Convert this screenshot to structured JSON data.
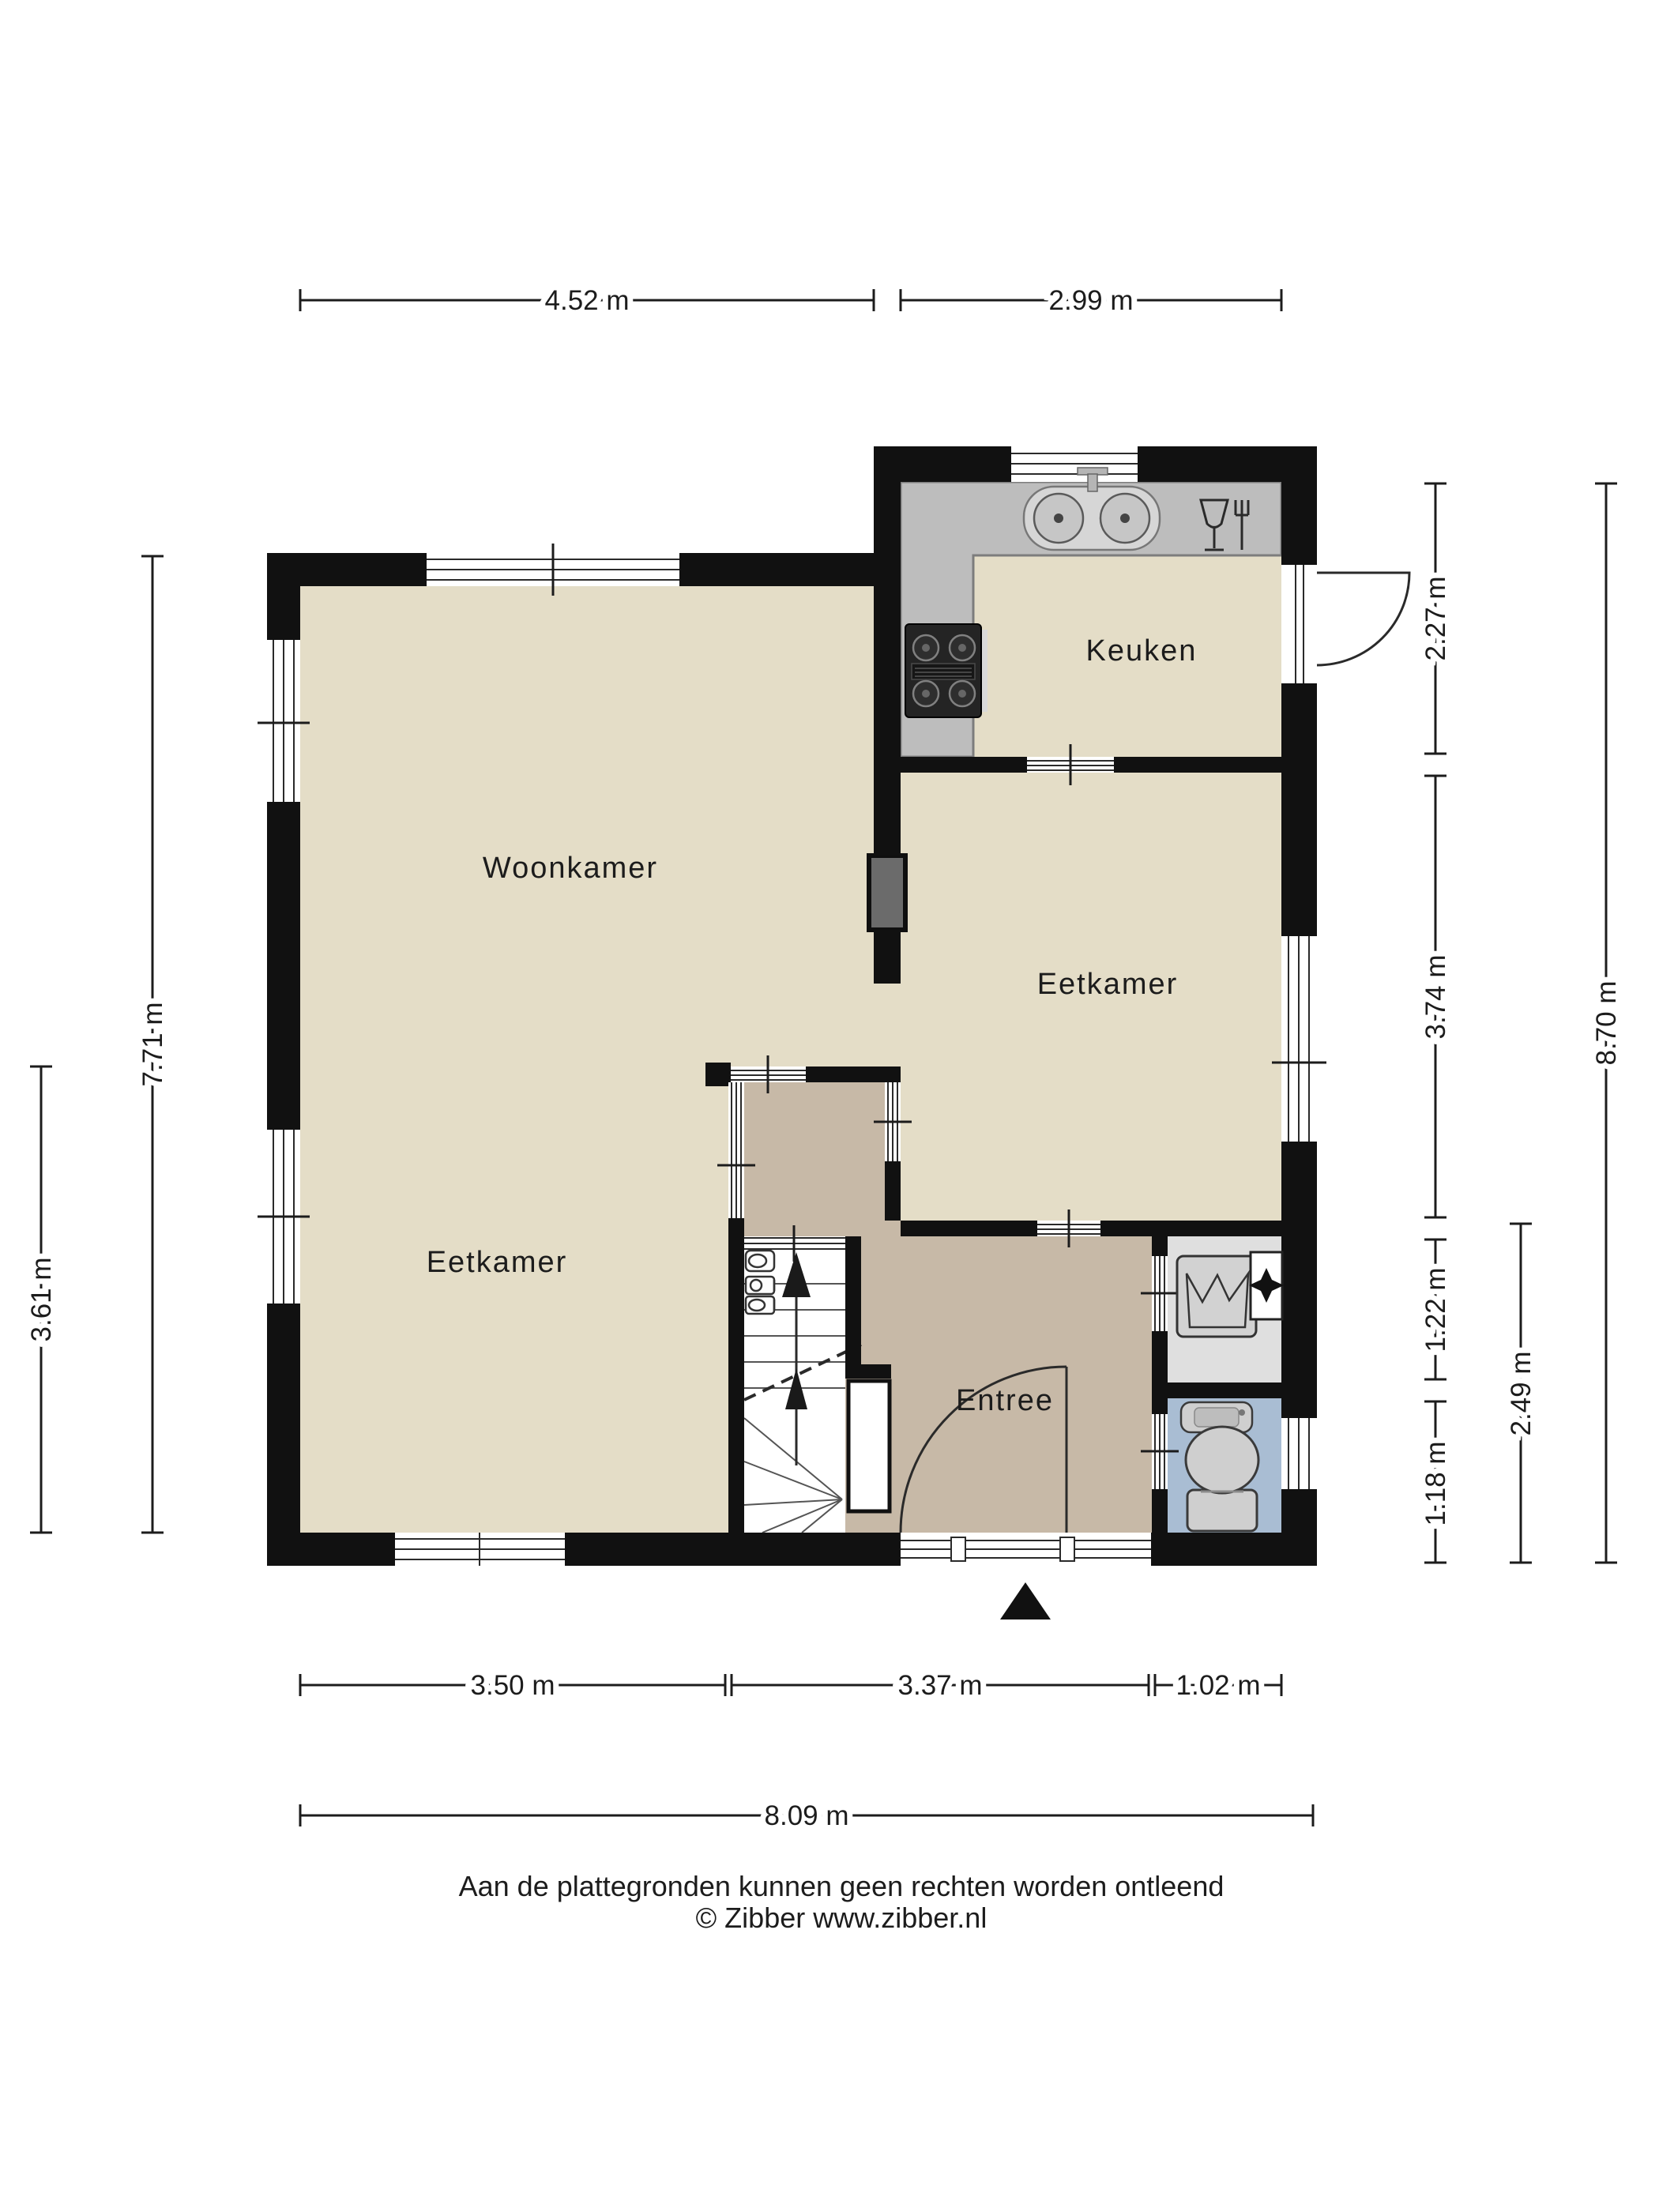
{
  "rooms": {
    "woonkamer": "Woonkamer",
    "keuken": "Keuken",
    "eetkamer_boven": "Eetkamer",
    "eetkamer_onder": "Eetkamer",
    "entree": "Entree"
  },
  "dimensions": {
    "top": [
      {
        "label": "4.52 m"
      },
      {
        "label": "2.99 m"
      }
    ],
    "left": [
      {
        "label": "7.71 m"
      },
      {
        "label": "3.61 m"
      }
    ],
    "right": [
      {
        "label": "2.27 m"
      },
      {
        "label": "3.74 m"
      },
      {
        "label": "1.22 m"
      },
      {
        "label": "1.18 m"
      },
      {
        "label": "2.49 m"
      },
      {
        "label": "8.70 m"
      }
    ],
    "bottom": [
      {
        "label": "3.50 m"
      },
      {
        "label": "3.37 m"
      },
      {
        "label": "1.02 m"
      },
      {
        "label": "8.09 m"
      }
    ]
  },
  "footer": {
    "line1": "Aan de plattegronden kunnen geen rechten worden ontleend",
    "line2": "© Zibber www.zibber.nl"
  },
  "icons": [
    "sink-icon",
    "stove-icon",
    "dishes-icon",
    "toilet-icon",
    "washbasin-icon",
    "boiler-icon",
    "ventilation-icon",
    "stairs-up-arrow-icon",
    "entrance-arrow-icon",
    "meter-icon"
  ],
  "colors": {
    "floor": "#e4ddc7",
    "entree_floor": "#c7b9a7",
    "wall": "#111111",
    "counter": "#bdbdbd",
    "counter_edge": "#7d7d7d",
    "tech_floor": "#dfdfdf",
    "wc_floor": "#a9bdd3",
    "shaft": "#6b6b6b",
    "fixture": "#cfcfcf",
    "fixture_edge": "#3a3a3a",
    "stair_floor": "#ffffff",
    "text": "#1c1c1c"
  }
}
